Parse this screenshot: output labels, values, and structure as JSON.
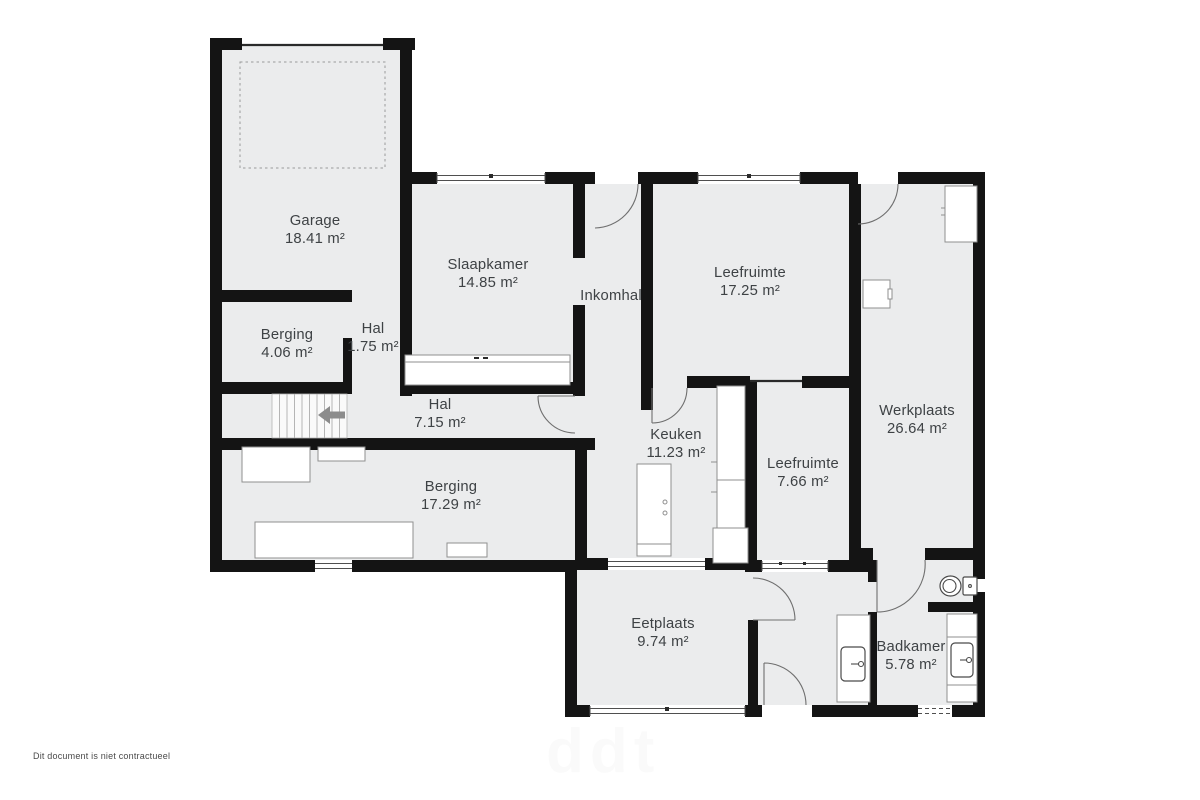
{
  "document": {
    "disclaimer": "Dit document is niet contractueel",
    "watermark": "ddt"
  },
  "colors": {
    "wall": "#141414",
    "floor": "#ebeced",
    "furniture": "#8f8f8f",
    "label": "#3e4245",
    "door": "#6f6f6f"
  },
  "fixtures": [
    "toilet",
    "sink",
    "washbasin",
    "stairs",
    "stairs-direction-arrow",
    "wardrobe",
    "kitchen-island",
    "kitchen-counter",
    "workbench",
    "storage-shelves",
    "garage-parking-outline"
  ],
  "rooms": [
    {
      "id": "garage",
      "name": "Garage",
      "area": "18.41 m²"
    },
    {
      "id": "slaapkamer",
      "name": "Slaapkamer",
      "area": "14.85 m²"
    },
    {
      "id": "inkomhal",
      "name": "Inkomhal",
      "area": ""
    },
    {
      "id": "leefruimte-1",
      "name": "Leefruimte",
      "area": "17.25 m²"
    },
    {
      "id": "werkplaats",
      "name": "Werkplaats",
      "area": "26.64 m²"
    },
    {
      "id": "berging-1",
      "name": "Berging",
      "area": "4.06 m²"
    },
    {
      "id": "hal-1",
      "name": "Hal",
      "area": "1.75 m²"
    },
    {
      "id": "hal-2",
      "name": "Hal",
      "area": "7.15 m²"
    },
    {
      "id": "keuken",
      "name": "Keuken",
      "area": "11.23 m²"
    },
    {
      "id": "leefruimte-2",
      "name": "Leefruimte",
      "area": "7.66 m²"
    },
    {
      "id": "berging-2",
      "name": "Berging",
      "area": "17.29 m²"
    },
    {
      "id": "eetplaats",
      "name": "Eetplaats",
      "area": "9.74 m²"
    },
    {
      "id": "badkamer",
      "name": "Badkamer",
      "area": "5.78 m²"
    }
  ]
}
